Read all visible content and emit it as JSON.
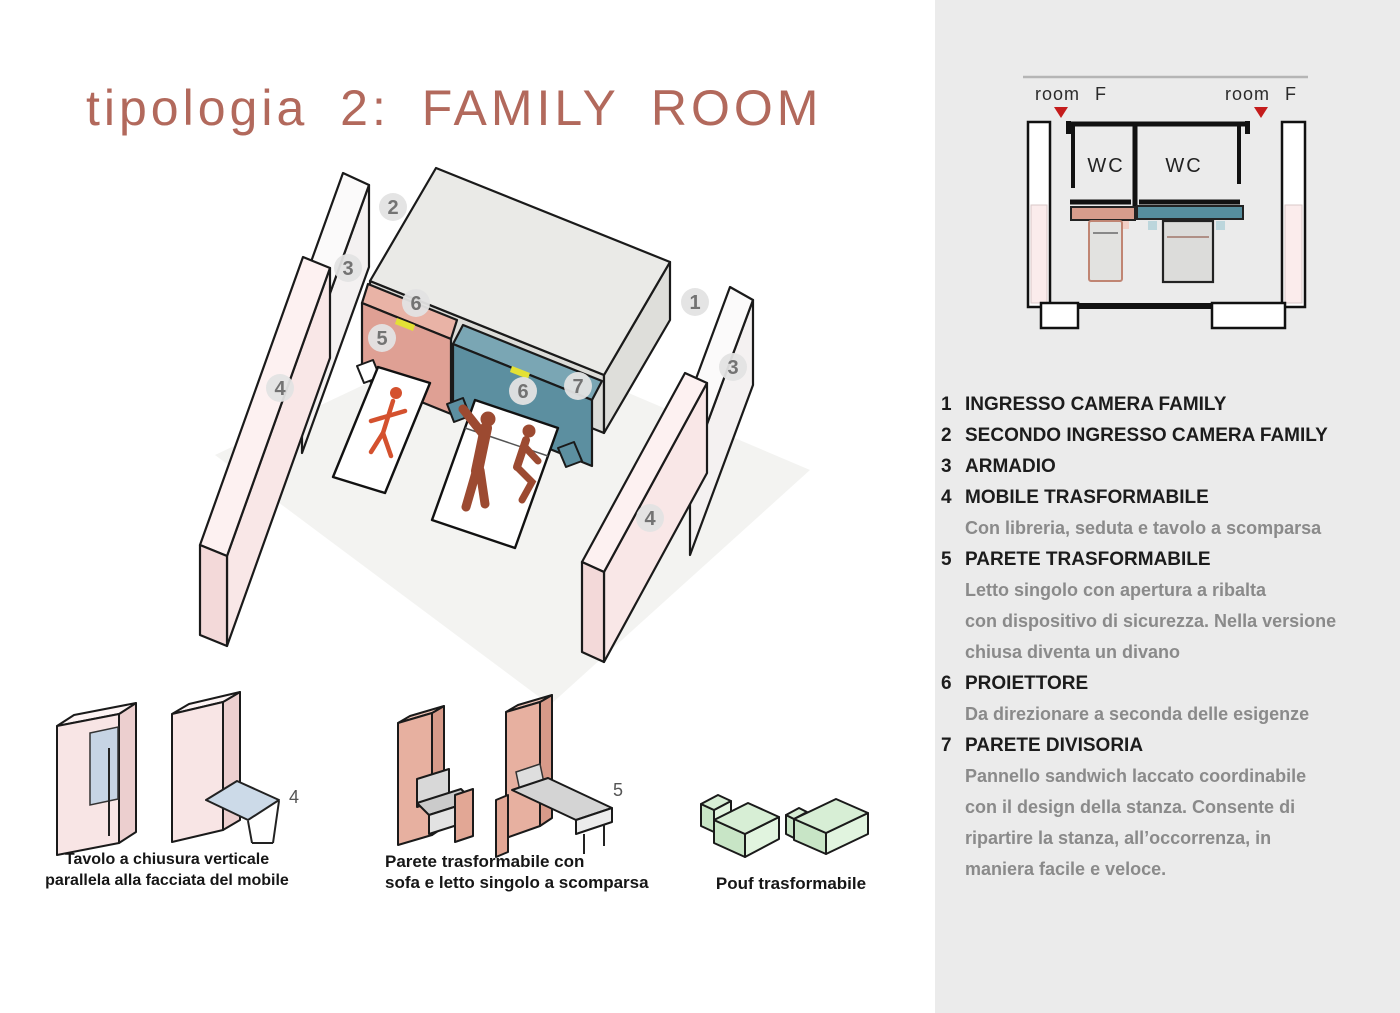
{
  "title": {
    "text": "tipologia 2: FAMILY ROOM",
    "color": "#b2695c"
  },
  "plan": {
    "room_label_left": "room F",
    "room_label_right": "room F",
    "wc_left": "WC",
    "wc_right": "WC",
    "colors": {
      "salmon_bar": "#d79c8c",
      "teal_bar": "#568e9e",
      "pink_column": "#fbecec",
      "red_marker": "#c41c1c"
    }
  },
  "axon": {
    "badges": [
      {
        "label": "2"
      },
      {
        "label": "3"
      },
      {
        "label": "6"
      },
      {
        "label": "5"
      },
      {
        "label": "1"
      },
      {
        "label": "3"
      },
      {
        "label": "7"
      },
      {
        "label": "6"
      },
      {
        "label": "4"
      },
      {
        "label": "4"
      }
    ],
    "colors": {
      "salmon_front": "#dfa094",
      "salmon_top": "#e9b3a6",
      "teal_front": "#5c8fa0",
      "teal_top": "#7aa6b4",
      "wall_pink": "#f9e7e7",
      "wall_white": "#f4f1f1",
      "slab_gray": "#eaeae7",
      "marker_yellow": "#e3e135",
      "figure_orange": "#d4512e",
      "figure_brown": "#9c4a31",
      "pouf_green": "#d7eed5"
    }
  },
  "legend": {
    "items": [
      {
        "num": "1",
        "title": "INGRESSO CAMERA FAMILY",
        "desc": []
      },
      {
        "num": "2",
        "title": "SECONDO INGRESSO CAMERA FAMILY",
        "desc": []
      },
      {
        "num": "3",
        "title": "ARMADIO",
        "desc": []
      },
      {
        "num": "4",
        "title": "MOBILE TRASFORMABILE",
        "desc": [
          "Con libreria, seduta e tavolo a scomparsa"
        ]
      },
      {
        "num": "5",
        "title": "PARETE TRASFORMABILE",
        "desc": [
          "Letto singolo con apertura a ribalta",
          "con dispositivo di sicurezza. Nella versione",
          "chiusa diventa un divano"
        ]
      },
      {
        "num": "6",
        "title": "PROIETTORE",
        "desc": [
          "Da direzionare a seconda delle esigenze"
        ]
      },
      {
        "num": "7",
        "title": "PARETE DIVISORIA",
        "desc": [
          "Pannello sandwich laccato coordinabile",
          "con il design della stanza. Consente di",
          "ripartire la stanza, all’occorrenza, in",
          "maniera facile e veloce."
        ]
      }
    ]
  },
  "illustrations": [
    {
      "label": "4",
      "caption_lines": [
        "Tavolo a chiusura verticale",
        "parallela alla facciata del mobile"
      ]
    },
    {
      "label": "5",
      "caption_lines": [
        "Parete trasformabile con",
        "sofa e letto singolo a scomparsa"
      ]
    },
    {
      "label": "",
      "caption_lines": [
        "Pouf trasformabile"
      ]
    }
  ]
}
